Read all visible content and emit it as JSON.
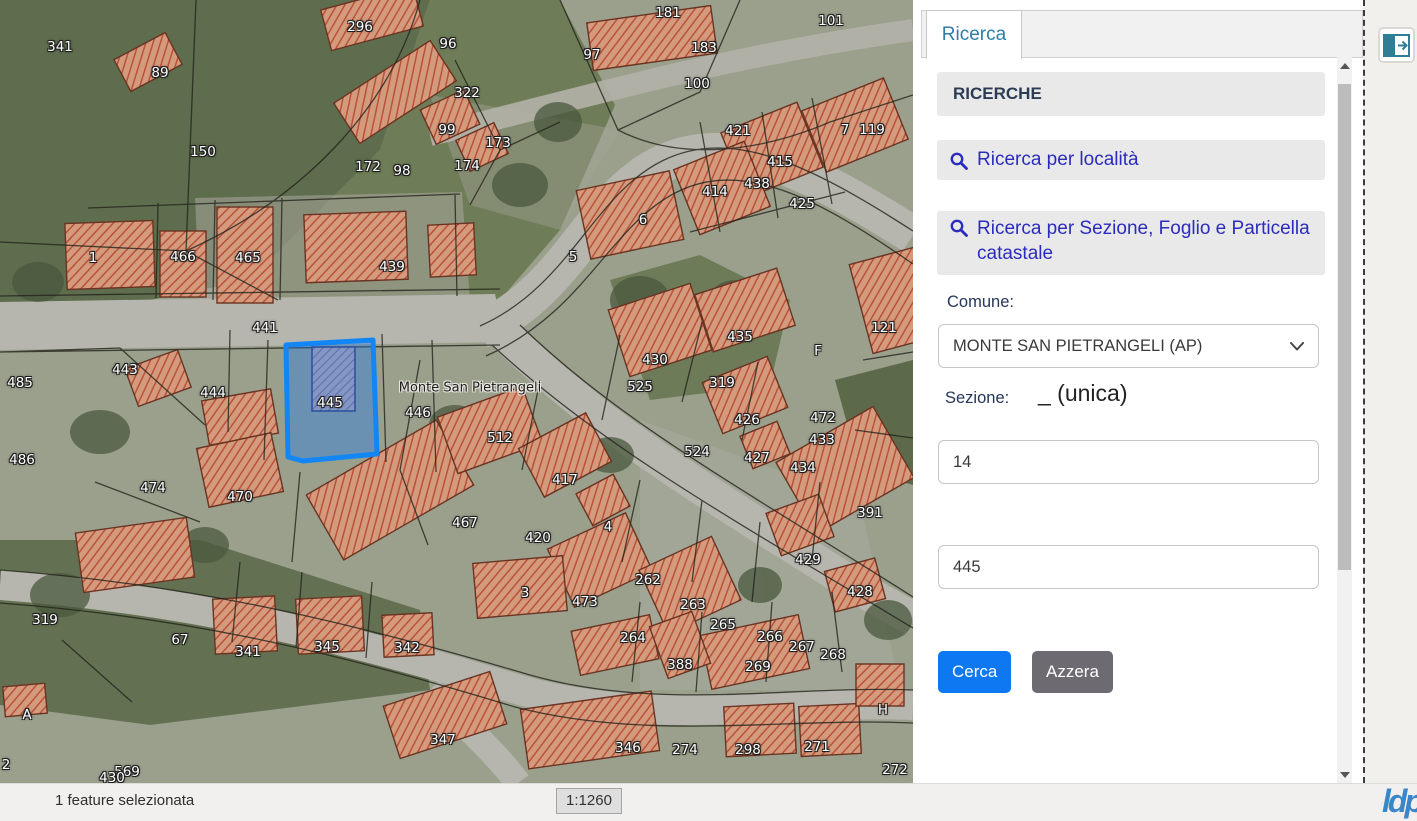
{
  "panel": {
    "tab_label": "Ricerca",
    "sections_header": "RICERCHE",
    "search_locality": "Ricerca per località",
    "search_cadastral": "Ricerca per Sezione, Foglio e Particella catastale",
    "comune_label": "Comune:",
    "comune_value": "MONTE SAN PIETRANGELI (AP)",
    "sezione_label": "Sezione:",
    "sezione_value": "_ (unica)",
    "foglio_value": "14",
    "particella_value": "445",
    "search_button": "Cerca",
    "clear_button": "Azzera"
  },
  "statusbar": {
    "selection_text": "1 feature selezionata",
    "scale_text": "1:1260",
    "logo_text": "ldp"
  },
  "colors": {
    "highlight_blue": "#1286f5",
    "primary_button": "#0d78f2",
    "secondary_button": "#6d6a72",
    "link_blue": "#2b2bbf",
    "tab_blue": "#2e7da6"
  },
  "map": {
    "selected_parcel": "445",
    "labels": [
      {
        "t": "341",
        "x": 60,
        "y": 47
      },
      {
        "t": "89",
        "x": 160,
        "y": 73
      },
      {
        "t": "296",
        "x": 360,
        "y": 27
      },
      {
        "t": "96",
        "x": 448,
        "y": 44
      },
      {
        "t": "97",
        "x": 592,
        "y": 55
      },
      {
        "t": "181",
        "x": 668,
        "y": 13
      },
      {
        "t": "183",
        "x": 704,
        "y": 48
      },
      {
        "t": "101",
        "x": 831,
        "y": 21
      },
      {
        "t": "100",
        "x": 697,
        "y": 84
      },
      {
        "t": "322",
        "x": 467,
        "y": 93
      },
      {
        "t": "99",
        "x": 447,
        "y": 130
      },
      {
        "t": "173",
        "x": 498,
        "y": 143
      },
      {
        "t": "174",
        "x": 467,
        "y": 166
      },
      {
        "t": "172",
        "x": 368,
        "y": 167
      },
      {
        "t": "98",
        "x": 402,
        "y": 171
      },
      {
        "t": "150",
        "x": 203,
        "y": 152
      },
      {
        "t": "7",
        "x": 845,
        "y": 130
      },
      {
        "t": "119",
        "x": 872,
        "y": 130
      },
      {
        "t": "421",
        "x": 738,
        "y": 131
      },
      {
        "t": "415",
        "x": 780,
        "y": 162
      },
      {
        "t": "438",
        "x": 757,
        "y": 184
      },
      {
        "t": "414",
        "x": 715,
        "y": 192
      },
      {
        "t": "425",
        "x": 802,
        "y": 204
      },
      {
        "t": "6",
        "x": 643,
        "y": 220
      },
      {
        "t": "5",
        "x": 573,
        "y": 257
      },
      {
        "t": "1",
        "x": 93,
        "y": 258
      },
      {
        "t": "466",
        "x": 183,
        "y": 257
      },
      {
        "t": "465",
        "x": 248,
        "y": 258
      },
      {
        "t": "439",
        "x": 392,
        "y": 267
      },
      {
        "t": "441",
        "x": 265,
        "y": 328
      },
      {
        "t": "121",
        "x": 884,
        "y": 328
      },
      {
        "t": "F",
        "x": 818,
        "y": 351
      },
      {
        "t": "443",
        "x": 125,
        "y": 370
      },
      {
        "t": "485",
        "x": 20,
        "y": 383
      },
      {
        "t": "444",
        "x": 213,
        "y": 393
      },
      {
        "t": "445",
        "x": 330,
        "y": 403
      },
      {
        "t": "Monte San Pietrangeli",
        "x": 470,
        "y": 388,
        "dark": true
      },
      {
        "t": "446",
        "x": 418,
        "y": 413
      },
      {
        "t": "435",
        "x": 740,
        "y": 337
      },
      {
        "t": "430",
        "x": 655,
        "y": 360
      },
      {
        "t": "525",
        "x": 640,
        "y": 387
      },
      {
        "t": "319",
        "x": 722,
        "y": 383
      },
      {
        "t": "426",
        "x": 747,
        "y": 420
      },
      {
        "t": "472",
        "x": 823,
        "y": 418
      },
      {
        "t": "433",
        "x": 822,
        "y": 440
      },
      {
        "t": "524",
        "x": 697,
        "y": 452
      },
      {
        "t": "427",
        "x": 757,
        "y": 458
      },
      {
        "t": "434",
        "x": 803,
        "y": 468
      },
      {
        "t": "486",
        "x": 22,
        "y": 460
      },
      {
        "t": "474",
        "x": 153,
        "y": 488
      },
      {
        "t": "470",
        "x": 240,
        "y": 497
      },
      {
        "t": "512",
        "x": 500,
        "y": 438
      },
      {
        "t": "417",
        "x": 565,
        "y": 480
      },
      {
        "t": "467",
        "x": 465,
        "y": 523
      },
      {
        "t": "391",
        "x": 870,
        "y": 513
      },
      {
        "t": "420",
        "x": 538,
        "y": 538
      },
      {
        "t": "4",
        "x": 608,
        "y": 527
      },
      {
        "t": "429",
        "x": 808,
        "y": 560
      },
      {
        "t": "262",
        "x": 648,
        "y": 580
      },
      {
        "t": "473",
        "x": 585,
        "y": 602
      },
      {
        "t": "3",
        "x": 525,
        "y": 593
      },
      {
        "t": "263",
        "x": 693,
        "y": 605
      },
      {
        "t": "428",
        "x": 860,
        "y": 592
      },
      {
        "t": "265",
        "x": 723,
        "y": 625
      },
      {
        "t": "264",
        "x": 633,
        "y": 638
      },
      {
        "t": "266",
        "x": 770,
        "y": 637
      },
      {
        "t": "267",
        "x": 802,
        "y": 647
      },
      {
        "t": "268",
        "x": 833,
        "y": 655
      },
      {
        "t": "388",
        "x": 680,
        "y": 665
      },
      {
        "t": "269",
        "x": 758,
        "y": 667
      },
      {
        "t": "319",
        "x": 45,
        "y": 620
      },
      {
        "t": "67",
        "x": 180,
        "y": 640
      },
      {
        "t": "341",
        "x": 248,
        "y": 652
      },
      {
        "t": "345",
        "x": 327,
        "y": 647
      },
      {
        "t": "342",
        "x": 407,
        "y": 648
      },
      {
        "t": "A",
        "x": 27,
        "y": 715
      },
      {
        "t": "H",
        "x": 883,
        "y": 710
      },
      {
        "t": "347",
        "x": 443,
        "y": 740
      },
      {
        "t": "346",
        "x": 628,
        "y": 748
      },
      {
        "t": "274",
        "x": 685,
        "y": 750
      },
      {
        "t": "298",
        "x": 748,
        "y": 750
      },
      {
        "t": "271",
        "x": 817,
        "y": 747
      },
      {
        "t": "272",
        "x": 895,
        "y": 770
      },
      {
        "t": "569",
        "x": 127,
        "y": 772
      },
      {
        "t": "430",
        "x": 112,
        "y": 778
      },
      {
        "t": "2",
        "x": 6,
        "y": 765
      }
    ]
  }
}
